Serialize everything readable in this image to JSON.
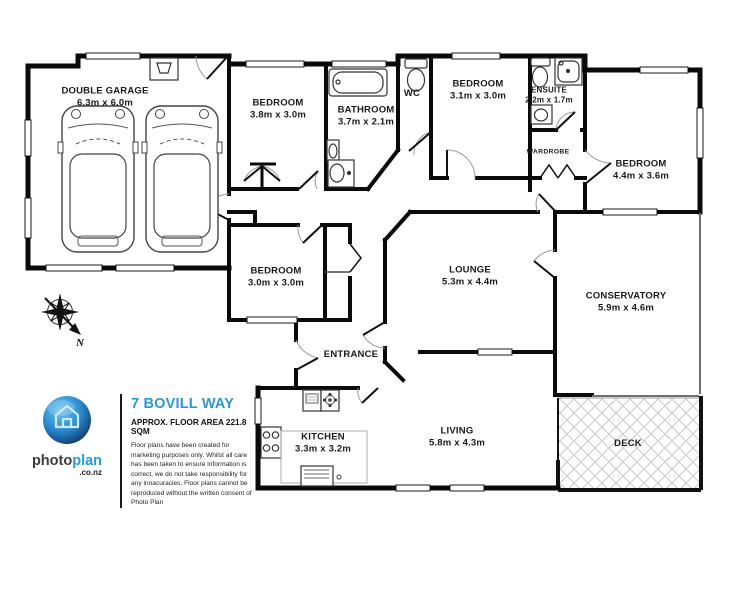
{
  "branding": {
    "logo_word_photo": "photo",
    "logo_word_plan": "plan",
    "logo_suffix": ".co.nz",
    "title": "7 BOVILL WAY",
    "floor_area": "APPROX. FLOOR AREA 221.8 SQM",
    "disclaimer": "Floor plans have been created for marketing purposes only. Whilst all care has been taken to ensure information is correct, we do not take responsibility for any innacuracies. Floor plans cannot be reproduced without the written consent of Photo Plan",
    "accent_color": "#2b97d4"
  },
  "compass": {
    "label": "N"
  },
  "rooms": [
    {
      "id": "double-garage",
      "name": "DOUBLE GARAGE",
      "dims": "6.3m x 6.0m"
    },
    {
      "id": "bedroom-1",
      "name": "BEDROOM",
      "dims": "3.8m x 3.0m"
    },
    {
      "id": "bathroom",
      "name": "BATHROOM",
      "dims": "3.7m x 2.1m"
    },
    {
      "id": "wc",
      "name": "WC",
      "dims": ""
    },
    {
      "id": "bedroom-2",
      "name": "BEDROOM",
      "dims": "3.1m x 3.0m"
    },
    {
      "id": "ensuite",
      "name": "ENSUITE",
      "dims": "2.2m x 1.7m"
    },
    {
      "id": "wardrobe",
      "name": "WARDROBE",
      "dims": ""
    },
    {
      "id": "bedroom-3",
      "name": "BEDROOM",
      "dims": "4.4m x 3.6m"
    },
    {
      "id": "bedroom-4",
      "name": "BEDROOM",
      "dims": "3.0m x 3.0m"
    },
    {
      "id": "lounge",
      "name": "LOUNGE",
      "dims": "5.3m x 4.4m"
    },
    {
      "id": "conservatory",
      "name": "CONSERVATORY",
      "dims": "5.9m x 4.6m"
    },
    {
      "id": "entrance",
      "name": "ENTRANCE",
      "dims": ""
    },
    {
      "id": "kitchen",
      "name": "KITCHEN",
      "dims": "3.3m x 3.2m"
    },
    {
      "id": "living",
      "name": "LIVING",
      "dims": "5.8m x 4.3m"
    },
    {
      "id": "deck",
      "name": "DECK",
      "dims": ""
    }
  ]
}
